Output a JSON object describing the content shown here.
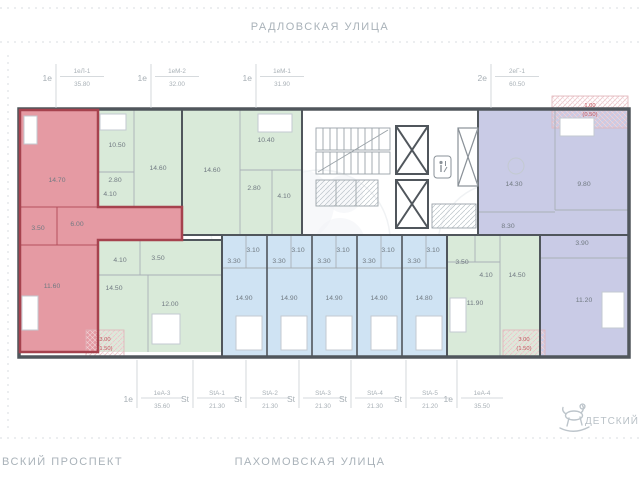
{
  "streets": {
    "top": "РАДЛОВСКАЯ  УЛИЦА",
    "bottom_center": "ПАХОМОВСКАЯ  УЛИЦА",
    "bottom_left": "ВСКИЙ  ПРОСПЕКТ"
  },
  "landmark": {
    "label": "ДЕТСКИЙ",
    "icon": "rocking-horse-icon"
  },
  "colors": {
    "highlight_fill": "#e59aa3",
    "highlight_wall": "#a6424e",
    "green_fill": "#d9ead9",
    "blue_fill": "#cfe3f3",
    "purple_fill": "#c9cbe6",
    "wall": "#50565c",
    "label_gray": "#a8b0b6",
    "red_text": "#c2565e"
  },
  "top_units": [
    {
      "prefix": "1е",
      "code": "1еЛ-1",
      "area": "35.80"
    },
    {
      "prefix": "1е",
      "code": "1еМ-2",
      "area": "32.00"
    },
    {
      "prefix": "1е",
      "code": "1еМ-1",
      "area": "31.90"
    },
    {
      "prefix": "2е",
      "code": "2еГ-1",
      "area": "60.50"
    }
  ],
  "bottom_units": [
    {
      "prefix": "1е",
      "code": "1еА-3",
      "area": "35.60"
    },
    {
      "prefix": "St",
      "code": "StА-1",
      "area": "21.30"
    },
    {
      "prefix": "St",
      "code": "StА-2",
      "area": "21.30"
    },
    {
      "prefix": "St",
      "code": "StА-3",
      "area": "21.30"
    },
    {
      "prefix": "St",
      "code": "StА-4",
      "area": "21.30"
    },
    {
      "prefix": "St",
      "code": "StА-5",
      "area": "21.20"
    },
    {
      "prefix": "1е",
      "code": "1еА-4",
      "area": "35.50"
    }
  ],
  "apartments": {
    "red": {
      "rooms": [
        "14.70",
        "3.50",
        "6.00",
        "11.60"
      ]
    },
    "m2": {
      "rooms": [
        "10.50",
        "14.60",
        "2.80",
        "4.10"
      ]
    },
    "m1": {
      "rooms": [
        "14.60",
        "10.40",
        "2.80",
        "4.10"
      ]
    },
    "g1": {
      "rooms": [
        "14.30",
        "9.80",
        "8.30",
        "3.90",
        "11.20"
      ]
    },
    "a3": {
      "rooms": [
        "4.10",
        "3.50",
        "14.50",
        "12.00"
      ]
    },
    "a4": {
      "rooms": [
        "3.50",
        "4.10",
        "14.50",
        "11.90"
      ]
    },
    "studios": [
      {
        "hall": "3.30",
        "bath": "3.10",
        "main": "14.90"
      },
      {
        "hall": "3.30",
        "bath": "3.10",
        "main": "14.90"
      },
      {
        "hall": "3.30",
        "bath": "3.10",
        "main": "14.90"
      },
      {
        "hall": "3.30",
        "bath": "3.10",
        "main": "14.90"
      },
      {
        "hall": "3.30",
        "bath": "3.10",
        "main": "14.80"
      }
    ]
  },
  "balconies": [
    {
      "area": "3.00",
      "counted": "(1.50)"
    },
    {
      "area": "1.00",
      "counted": "(0.50)"
    },
    {
      "area": "3.00",
      "counted": "(1.50)"
    }
  ]
}
